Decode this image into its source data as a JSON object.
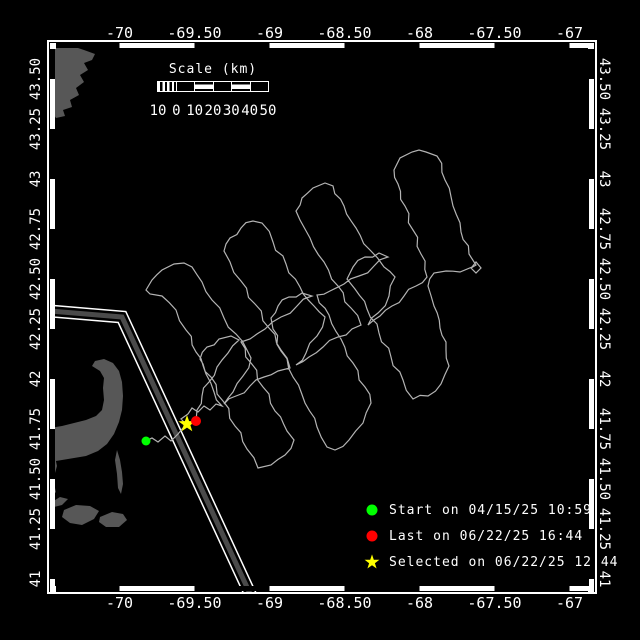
{
  "window": {
    "background": "#000000"
  },
  "map": {
    "colors": {
      "background": "#000000",
      "frame": "#ffffff",
      "text": "#ffffff",
      "track": "#b4b4b4",
      "land": "#575757",
      "lane_fill": "#4a4a4a",
      "start": "#00ff00",
      "last": "#ff0000",
      "selected": "#ffff00"
    },
    "axes": {
      "lon_ticks": [
        {
          "label": "-70",
          "value": -70
        },
        {
          "label": "-69.50",
          "value": -69.5
        },
        {
          "label": "-69",
          "value": -69
        },
        {
          "label": "-68.50",
          "value": -68.5
        },
        {
          "label": "-68",
          "value": -68
        },
        {
          "label": "-67.50",
          "value": -67.5
        },
        {
          "label": "-67",
          "value": -67
        }
      ],
      "lat_ticks": [
        {
          "label": "43.50",
          "value": 43.5
        },
        {
          "label": "43.25",
          "value": 43.25
        },
        {
          "label": "43",
          "value": 43
        },
        {
          "label": "42.75",
          "value": 42.75
        },
        {
          "label": "42.50",
          "value": 42.5
        },
        {
          "label": "42.25",
          "value": 42.25
        },
        {
          "label": "42",
          "value": 42
        },
        {
          "label": "41.75",
          "value": 41.75
        },
        {
          "label": "41.50",
          "value": 41.5
        },
        {
          "label": "41.25",
          "value": 41.25
        },
        {
          "label": "41",
          "value": 41
        }
      ]
    },
    "scalebar": {
      "title": "Scale (km)",
      "tick_labels": [
        "10",
        "0",
        "10",
        "20",
        "30",
        "40",
        "50"
      ]
    },
    "legend": {
      "items": [
        {
          "marker": "circle",
          "color": "#00ff00",
          "label": "Start on 04/15/25 10:59"
        },
        {
          "marker": "circle",
          "color": "#ff0000",
          "label": "Last on 06/22/25 16:44"
        },
        {
          "marker": "star",
          "color": "#ffff00",
          "label": "Selected on 06/22/25 12:44"
        }
      ]
    },
    "markers": {
      "start": {
        "x": 146,
        "y": 441
      },
      "last": {
        "x": 196,
        "y": 421
      },
      "selected": {
        "x": 187,
        "y": 424
      }
    },
    "lane_px": [
      [
        50,
        311
      ],
      [
        122,
        317
      ],
      [
        252,
        598
      ]
    ],
    "land_px": {
      "north_coast": [
        [
          50,
          45
        ],
        [
          60,
          44
        ],
        [
          72,
          46
        ],
        [
          84,
          50
        ],
        [
          95,
          54
        ],
        [
          92,
          60
        ],
        [
          84,
          63
        ],
        [
          88,
          70
        ],
        [
          80,
          75
        ],
        [
          84,
          82
        ],
        [
          76,
          88
        ],
        [
          79,
          95
        ],
        [
          70,
          100
        ],
        [
          72,
          107
        ],
        [
          63,
          110
        ],
        [
          65,
          116
        ],
        [
          56,
          118
        ],
        [
          52,
          112
        ],
        [
          50,
          108
        ]
      ],
      "mainland_strip": [
        [
          50,
          404
        ],
        [
          55,
          410
        ],
        [
          53,
          424
        ],
        [
          57,
          438
        ],
        [
          54,
          452
        ],
        [
          57,
          466
        ],
        [
          53,
          480
        ],
        [
          56,
          492
        ],
        [
          50,
          498
        ]
      ],
      "cape_cod": [
        [
          50,
          428
        ],
        [
          62,
          426
        ],
        [
          74,
          423
        ],
        [
          86,
          420
        ],
        [
          96,
          416
        ],
        [
          102,
          410
        ],
        [
          104,
          400
        ],
        [
          103,
          388
        ],
        [
          104,
          378
        ],
        [
          100,
          371
        ],
        [
          92,
          366
        ],
        [
          95,
          361
        ],
        [
          104,
          359
        ],
        [
          113,
          363
        ],
        [
          119,
          371
        ],
        [
          122,
          382
        ],
        [
          123,
          396
        ],
        [
          122,
          410
        ],
        [
          119,
          422
        ],
        [
          114,
          434
        ],
        [
          107,
          444
        ],
        [
          98,
          451
        ],
        [
          86,
          456
        ],
        [
          74,
          458
        ],
        [
          62,
          460
        ],
        [
          50,
          462
        ]
      ],
      "monomoy": [
        [
          117,
          450
        ],
        [
          120,
          460
        ],
        [
          122,
          472
        ],
        [
          123,
          484
        ],
        [
          121,
          494
        ],
        [
          118,
          488
        ],
        [
          117,
          474
        ],
        [
          115,
          460
        ]
      ],
      "elizabeth_islands": [
        [
          52,
          502
        ],
        [
          60,
          497
        ],
        [
          68,
          499
        ],
        [
          62,
          505
        ],
        [
          54,
          507
        ]
      ],
      "marthas_vineyard": [
        [
          64,
          510
        ],
        [
          76,
          505
        ],
        [
          90,
          506
        ],
        [
          99,
          511
        ],
        [
          94,
          519
        ],
        [
          82,
          525
        ],
        [
          70,
          523
        ],
        [
          62,
          517
        ]
      ],
      "nantucket": [
        [
          100,
          517
        ],
        [
          112,
          512
        ],
        [
          123,
          514
        ],
        [
          127,
          520
        ],
        [
          119,
          527
        ],
        [
          106,
          527
        ],
        [
          99,
          522
        ]
      ]
    },
    "track_px": [
      [
        146,
        441
      ],
      [
        152,
        438
      ],
      [
        158,
        442
      ],
      [
        165,
        436
      ],
      [
        171,
        441
      ],
      [
        178,
        434
      ],
      [
        183,
        428
      ],
      [
        187,
        425
      ],
      [
        181,
        419
      ],
      [
        188,
        414
      ],
      [
        192,
        408
      ],
      [
        198,
        412
      ],
      [
        204,
        406
      ],
      [
        210,
        410
      ],
      [
        216,
        404
      ],
      [
        222,
        406
      ],
      [
        214,
        392
      ],
      [
        206,
        374
      ],
      [
        196,
        352
      ],
      [
        186,
        330
      ],
      [
        176,
        310
      ],
      [
        162,
        296
      ],
      [
        150,
        294
      ],
      [
        146,
        290
      ],
      [
        152,
        280
      ],
      [
        162,
        270
      ],
      [
        174,
        264
      ],
      [
        184,
        263
      ],
      [
        192,
        267
      ],
      [
        202,
        282
      ],
      [
        212,
        300
      ],
      [
        224,
        318
      ],
      [
        236,
        334
      ],
      [
        247,
        350
      ],
      [
        251,
        358
      ],
      [
        243,
        376
      ],
      [
        233,
        392
      ],
      [
        224,
        404
      ],
      [
        236,
        396
      ],
      [
        250,
        386
      ],
      [
        264,
        377
      ],
      [
        278,
        371
      ],
      [
        290,
        368
      ],
      [
        281,
        350
      ],
      [
        269,
        328
      ],
      [
        255,
        304
      ],
      [
        241,
        281
      ],
      [
        230,
        262
      ],
      [
        224,
        251
      ],
      [
        230,
        238
      ],
      [
        241,
        228
      ],
      [
        253,
        221
      ],
      [
        262,
        223
      ],
      [
        273,
        242
      ],
      [
        286,
        264
      ],
      [
        300,
        287
      ],
      [
        314,
        306
      ],
      [
        325,
        317
      ],
      [
        317,
        336
      ],
      [
        306,
        353
      ],
      [
        296,
        365
      ],
      [
        309,
        357
      ],
      [
        323,
        347
      ],
      [
        338,
        337
      ],
      [
        352,
        329
      ],
      [
        361,
        325
      ],
      [
        351,
        308
      ],
      [
        338,
        286
      ],
      [
        324,
        262
      ],
      [
        310,
        238
      ],
      [
        300,
        220
      ],
      [
        296,
        211
      ],
      [
        302,
        198
      ],
      [
        313,
        188
      ],
      [
        325,
        183
      ],
      [
        333,
        186
      ],
      [
        344,
        206
      ],
      [
        356,
        228
      ],
      [
        370,
        250
      ],
      [
        384,
        267
      ],
      [
        395,
        277
      ],
      [
        389,
        296
      ],
      [
        378,
        313
      ],
      [
        368,
        325
      ],
      [
        380,
        316
      ],
      [
        392,
        306
      ],
      [
        404,
        296
      ],
      [
        416,
        286
      ],
      [
        427,
        277
      ],
      [
        421,
        254
      ],
      [
        413,
        230
      ],
      [
        405,
        206
      ],
      [
        398,
        184
      ],
      [
        394,
        170
      ],
      [
        400,
        158
      ],
      [
        412,
        152
      ],
      [
        426,
        152
      ],
      [
        437,
        156
      ],
      [
        445,
        180
      ],
      [
        453,
        206
      ],
      [
        461,
        232
      ],
      [
        469,
        254
      ],
      [
        476,
        265
      ],
      [
        471,
        268
      ],
      [
        476,
        273
      ],
      [
        481,
        268
      ],
      [
        476,
        262
      ],
      [
        472,
        267
      ],
      [
        460,
        272
      ],
      [
        446,
        271
      ],
      [
        434,
        273
      ],
      [
        428,
        286
      ],
      [
        434,
        306
      ],
      [
        440,
        328
      ],
      [
        446,
        350
      ],
      [
        449,
        366
      ],
      [
        441,
        384
      ],
      [
        428,
        396
      ],
      [
        413,
        399
      ],
      [
        403,
        380
      ],
      [
        391,
        357
      ],
      [
        379,
        333
      ],
      [
        367,
        309
      ],
      [
        355,
        289
      ],
      [
        347,
        279
      ],
      [
        353,
        267
      ],
      [
        365,
        257
      ],
      [
        379,
        253
      ],
      [
        388,
        257
      ],
      [
        374,
        266
      ],
      [
        359,
        276
      ],
      [
        344,
        284
      ],
      [
        330,
        291
      ],
      [
        317,
        295
      ],
      [
        329,
        315
      ],
      [
        341,
        339
      ],
      [
        353,
        363
      ],
      [
        365,
        387
      ],
      [
        371,
        403
      ],
      [
        363,
        423
      ],
      [
        349,
        440
      ],
      [
        335,
        450
      ],
      [
        327,
        447
      ],
      [
        317,
        427
      ],
      [
        305,
        403
      ],
      [
        293,
        377
      ],
      [
        281,
        351
      ],
      [
        273,
        329
      ],
      [
        271,
        318
      ],
      [
        278,
        306
      ],
      [
        289,
        297
      ],
      [
        302,
        293
      ],
      [
        312,
        296
      ],
      [
        297,
        306
      ],
      [
        281,
        317
      ],
      [
        265,
        329
      ],
      [
        250,
        339
      ],
      [
        241,
        342
      ],
      [
        251,
        363
      ],
      [
        263,
        387
      ],
      [
        275,
        411
      ],
      [
        287,
        431
      ],
      [
        294,
        440
      ],
      [
        285,
        455
      ],
      [
        271,
        465
      ],
      [
        258,
        468
      ],
      [
        247,
        449
      ],
      [
        235,
        426
      ],
      [
        223,
        401
      ],
      [
        211,
        377
      ],
      [
        203,
        364
      ],
      [
        200,
        359
      ],
      [
        207,
        347
      ],
      [
        219,
        339
      ],
      [
        231,
        336
      ],
      [
        239,
        340
      ],
      [
        228,
        353
      ],
      [
        217,
        367
      ],
      [
        209,
        382
      ],
      [
        202,
        396
      ],
      [
        197,
        410
      ],
      [
        196,
        421
      ]
    ]
  }
}
